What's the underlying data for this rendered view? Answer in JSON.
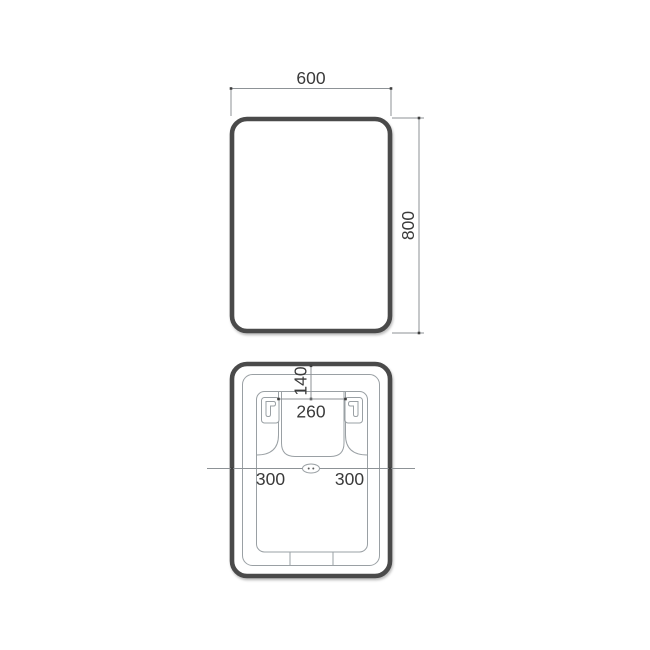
{
  "drawing": {
    "type": "technical-dimension-drawing",
    "subject": "rounded-rectangle-mirror",
    "colors": {
      "outline": "#4a4a4a",
      "thin_line": "#9aa0a4",
      "text": "#3a3a3a",
      "tick": "#3f3f3f",
      "background": "#ffffff"
    },
    "front_view": {
      "name": "front view",
      "width_label": "600",
      "height_label": "800"
    },
    "back_view": {
      "name": "back view with mounting brackets",
      "top_offset_label": "140",
      "bracket_spacing_label": "260",
      "left_edge_label": "300",
      "right_edge_label": "300"
    }
  }
}
